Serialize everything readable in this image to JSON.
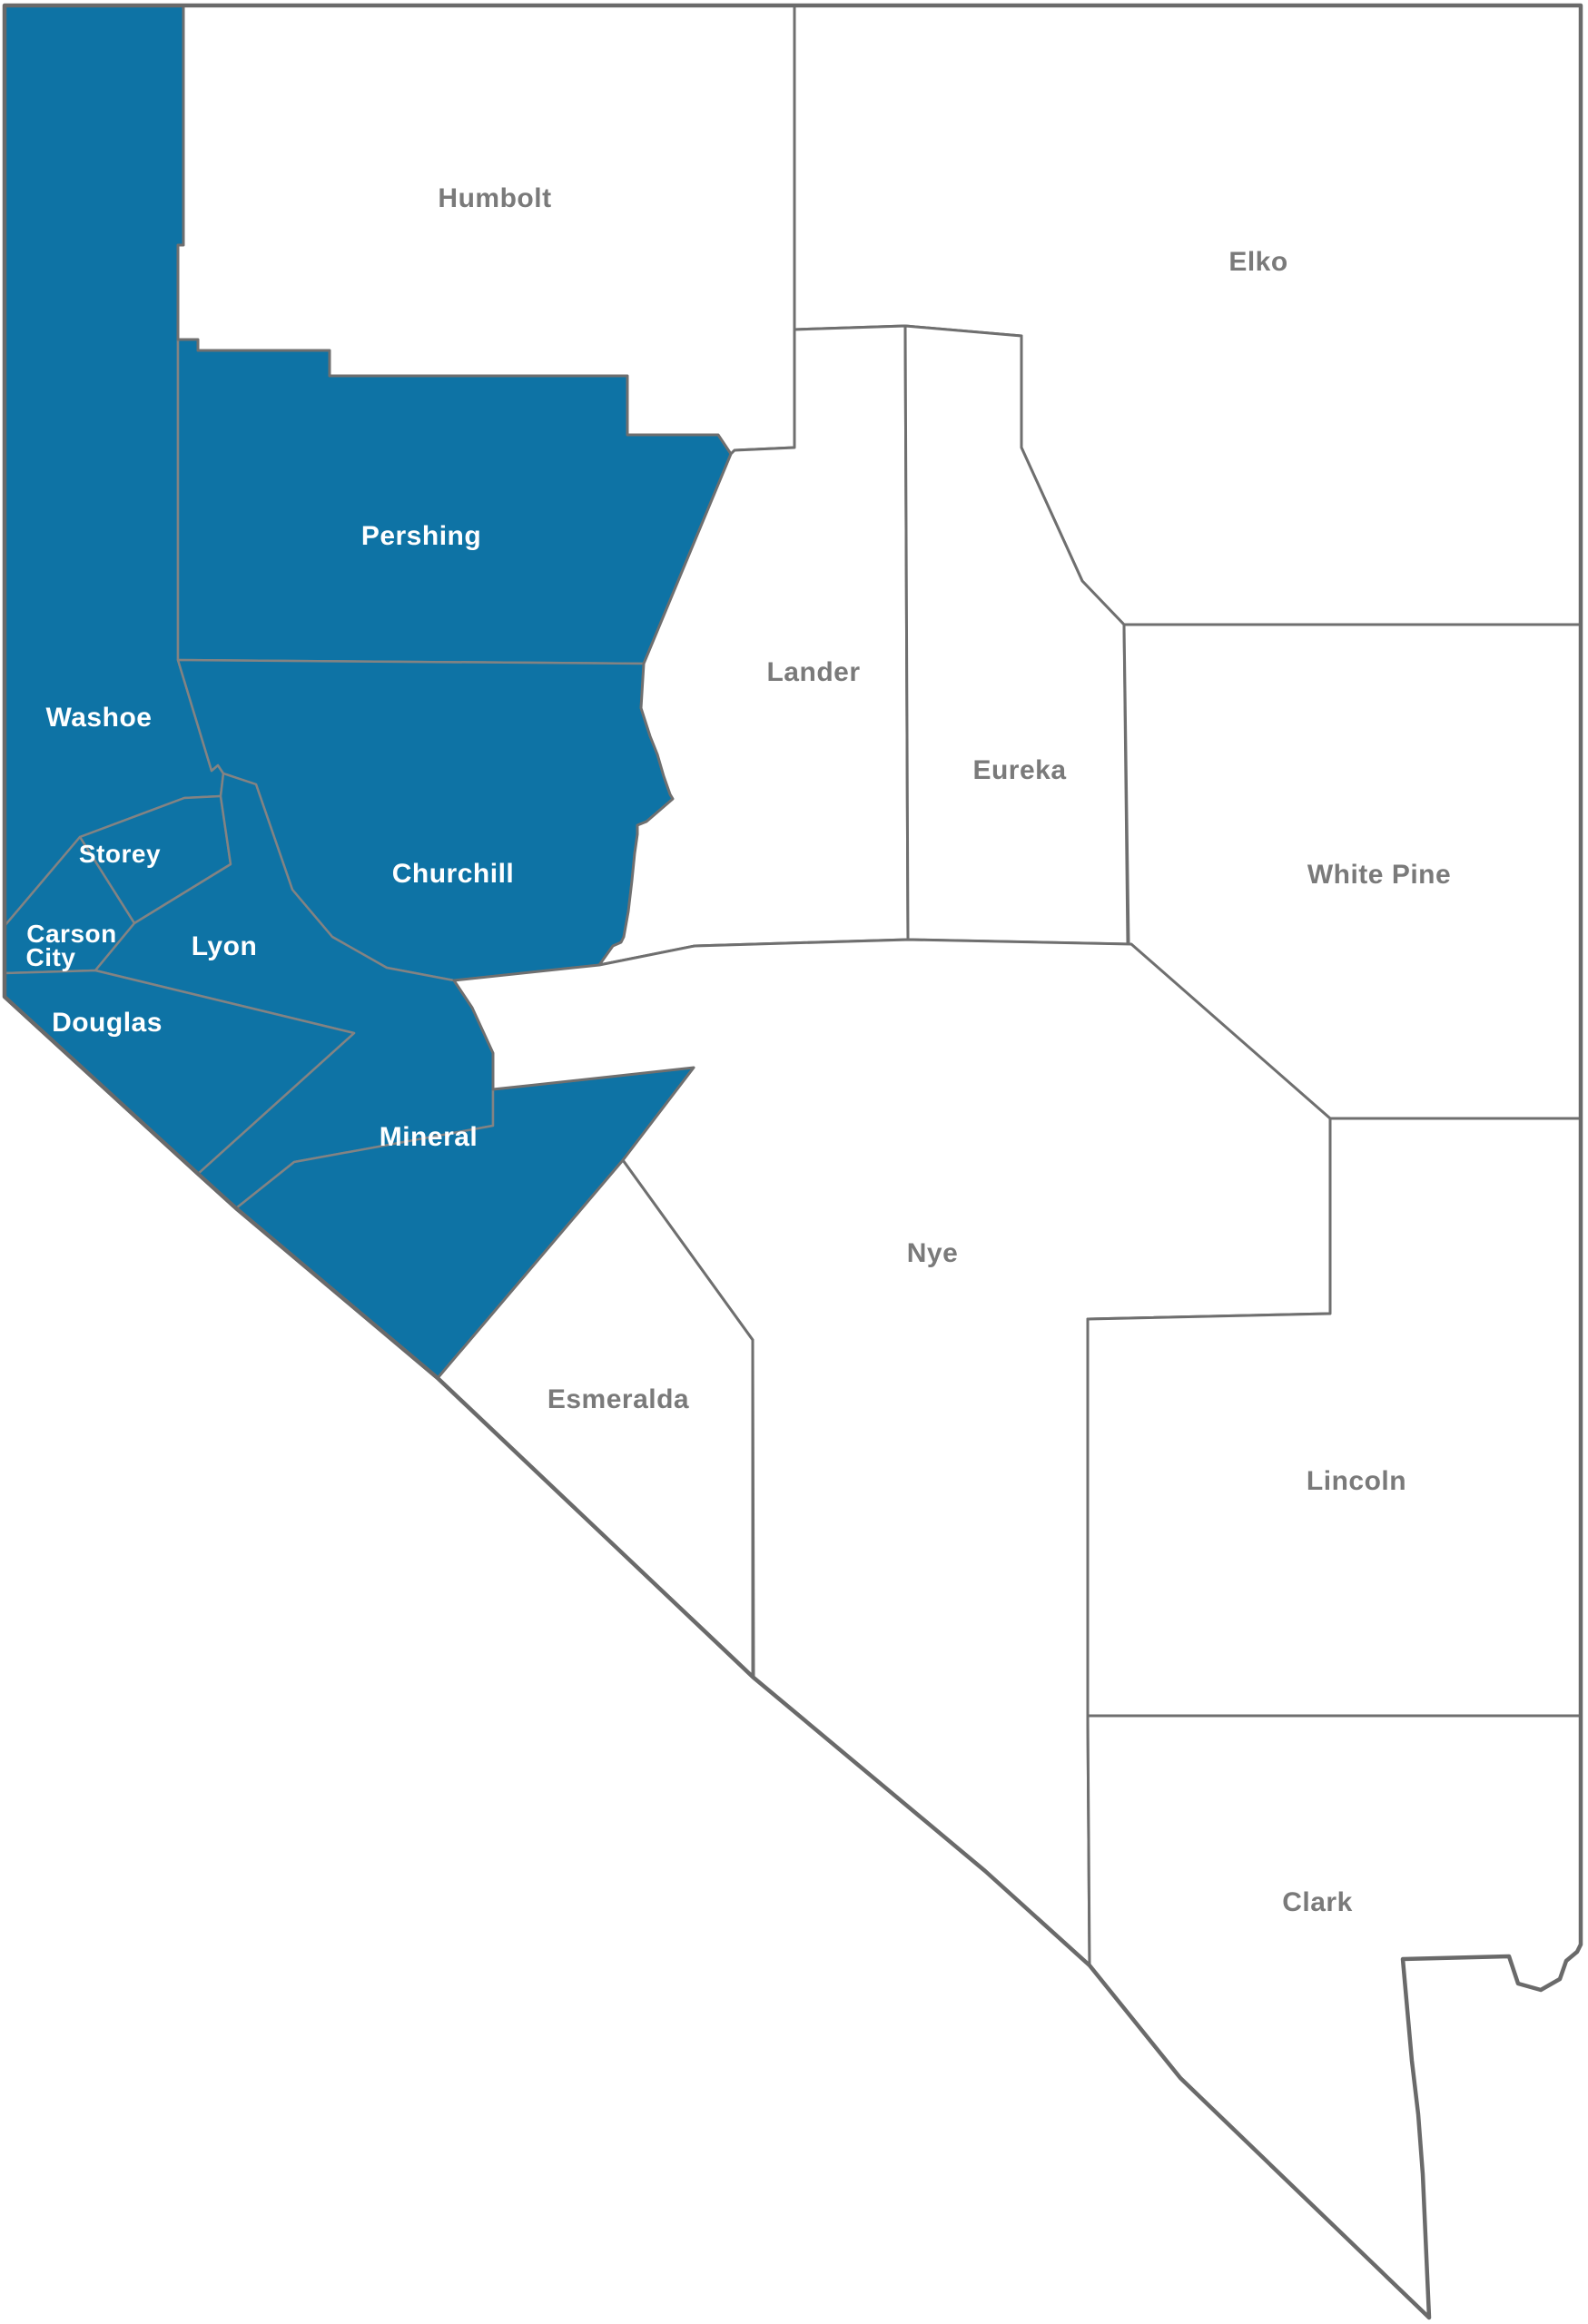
{
  "map_title": "Nevada counties map",
  "colors": {
    "highlighted": "#0e73a5",
    "default": "#ffffff",
    "border": "#6f6f6f",
    "inner_border": "#838383",
    "label_on_highlight": "#ffffff",
    "label_on_default": "#7a7a7a"
  },
  "counties": [
    {
      "id": "washoe",
      "name": "Washoe",
      "label_lines": [
        "Washoe"
      ],
      "highlighted": true
    },
    {
      "id": "humbolt",
      "name": "Humbolt",
      "label_lines": [
        "Humbolt"
      ],
      "highlighted": false
    },
    {
      "id": "elko",
      "name": "Elko",
      "label_lines": [
        "Elko"
      ],
      "highlighted": false
    },
    {
      "id": "pershing",
      "name": "Pershing",
      "label_lines": [
        "Pershing"
      ],
      "highlighted": true
    },
    {
      "id": "lander",
      "name": "Lander",
      "label_lines": [
        "Lander"
      ],
      "highlighted": false
    },
    {
      "id": "eureka",
      "name": "Eureka",
      "label_lines": [
        "Eureka"
      ],
      "highlighted": false
    },
    {
      "id": "white-pine",
      "name": "White Pine",
      "label_lines": [
        "White Pine"
      ],
      "highlighted": false
    },
    {
      "id": "churchill",
      "name": "Churchill",
      "label_lines": [
        "Churchill"
      ],
      "highlighted": true
    },
    {
      "id": "storey",
      "name": "Storey",
      "label_lines": [
        "Storey"
      ],
      "highlighted": true
    },
    {
      "id": "carson-city",
      "name": "Carson City",
      "label_lines": [
        "Carson",
        "City"
      ],
      "highlighted": true
    },
    {
      "id": "lyon",
      "name": "Lyon",
      "label_lines": [
        "Lyon"
      ],
      "highlighted": true
    },
    {
      "id": "douglas",
      "name": "Douglas",
      "label_lines": [
        "Douglas"
      ],
      "highlighted": true
    },
    {
      "id": "mineral",
      "name": "Mineral",
      "label_lines": [
        "Mineral"
      ],
      "highlighted": true
    },
    {
      "id": "nye",
      "name": "Nye",
      "label_lines": [
        "Nye"
      ],
      "highlighted": false
    },
    {
      "id": "esmeralda",
      "name": "Esmeralda",
      "label_lines": [
        "Esmeralda"
      ],
      "highlighted": false
    },
    {
      "id": "lincoln",
      "name": "Lincoln",
      "label_lines": [
        "Lincoln"
      ],
      "highlighted": false
    },
    {
      "id": "clark",
      "name": "Clark",
      "label_lines": [
        "Clark"
      ],
      "highlighted": false
    }
  ]
}
